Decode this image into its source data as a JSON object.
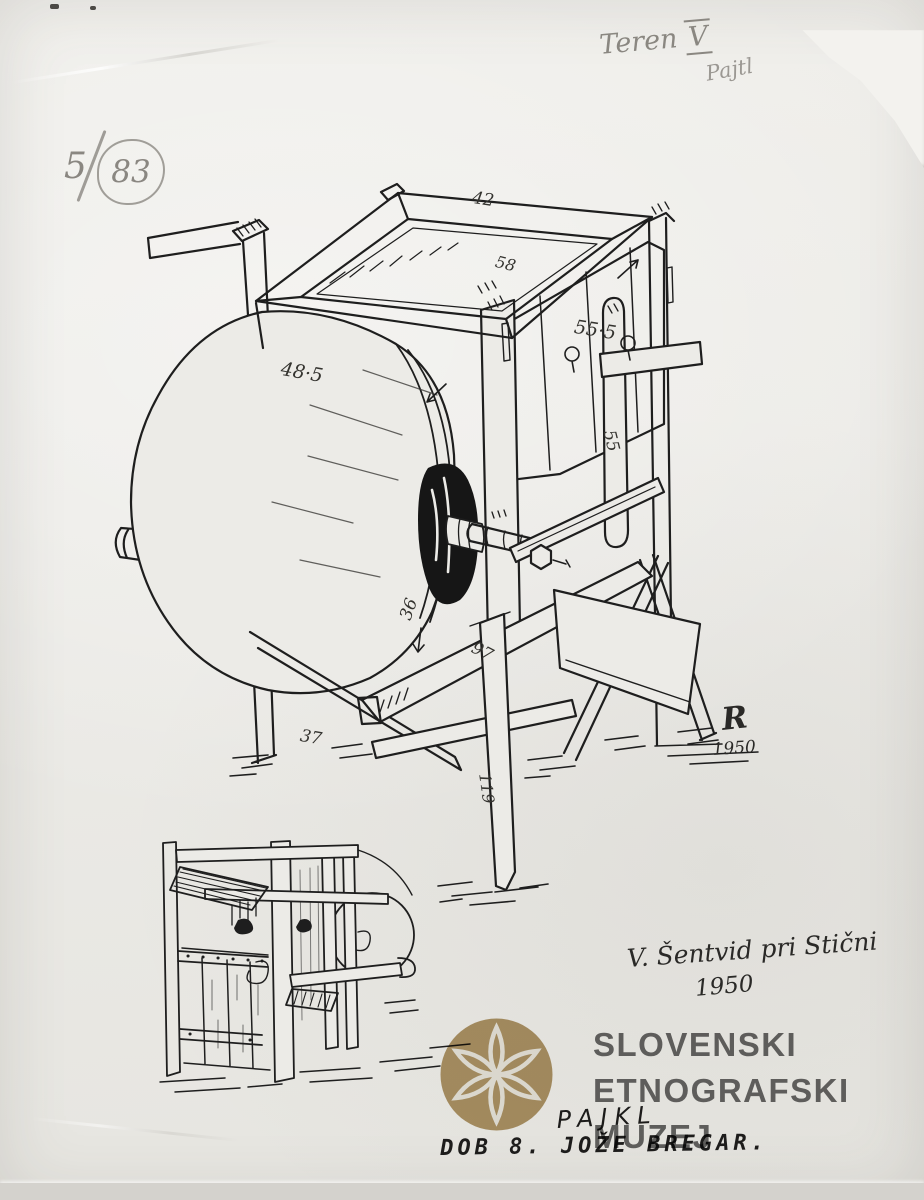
{
  "annotations": {
    "inventory_prefix": "5",
    "inventory_number": "83",
    "field_note_word": "Teren",
    "field_note_numeral": "V",
    "pencil_title": "Pajtl",
    "location": "V. Šentvid pri Stični",
    "location_year": "1950",
    "signature_initial": "R",
    "signature_year": "1950",
    "caption_handwritten": "PAJKL",
    "caption_typed": "DOB 8. JOŽE BREGAR."
  },
  "measurements": {
    "hopper_top": "42",
    "hopper_rim": "58",
    "body_side": "55·5",
    "drum_casing": "48·5",
    "slat": "55",
    "drum_face": "36",
    "support_beam": "97",
    "base": "37",
    "front_leg": "119"
  },
  "watermark": {
    "line1": "SLOVENSKI",
    "line2": "ETNOGRAFSKI",
    "line3": "MUZEJ",
    "logo": "six-petal-flower",
    "logo_color": "#b49a6b",
    "text_color": "#4f4f4f"
  },
  "colors": {
    "paper": "#ecebe7",
    "ink": "#1e1e1e",
    "pencil": "#8a8781"
  }
}
